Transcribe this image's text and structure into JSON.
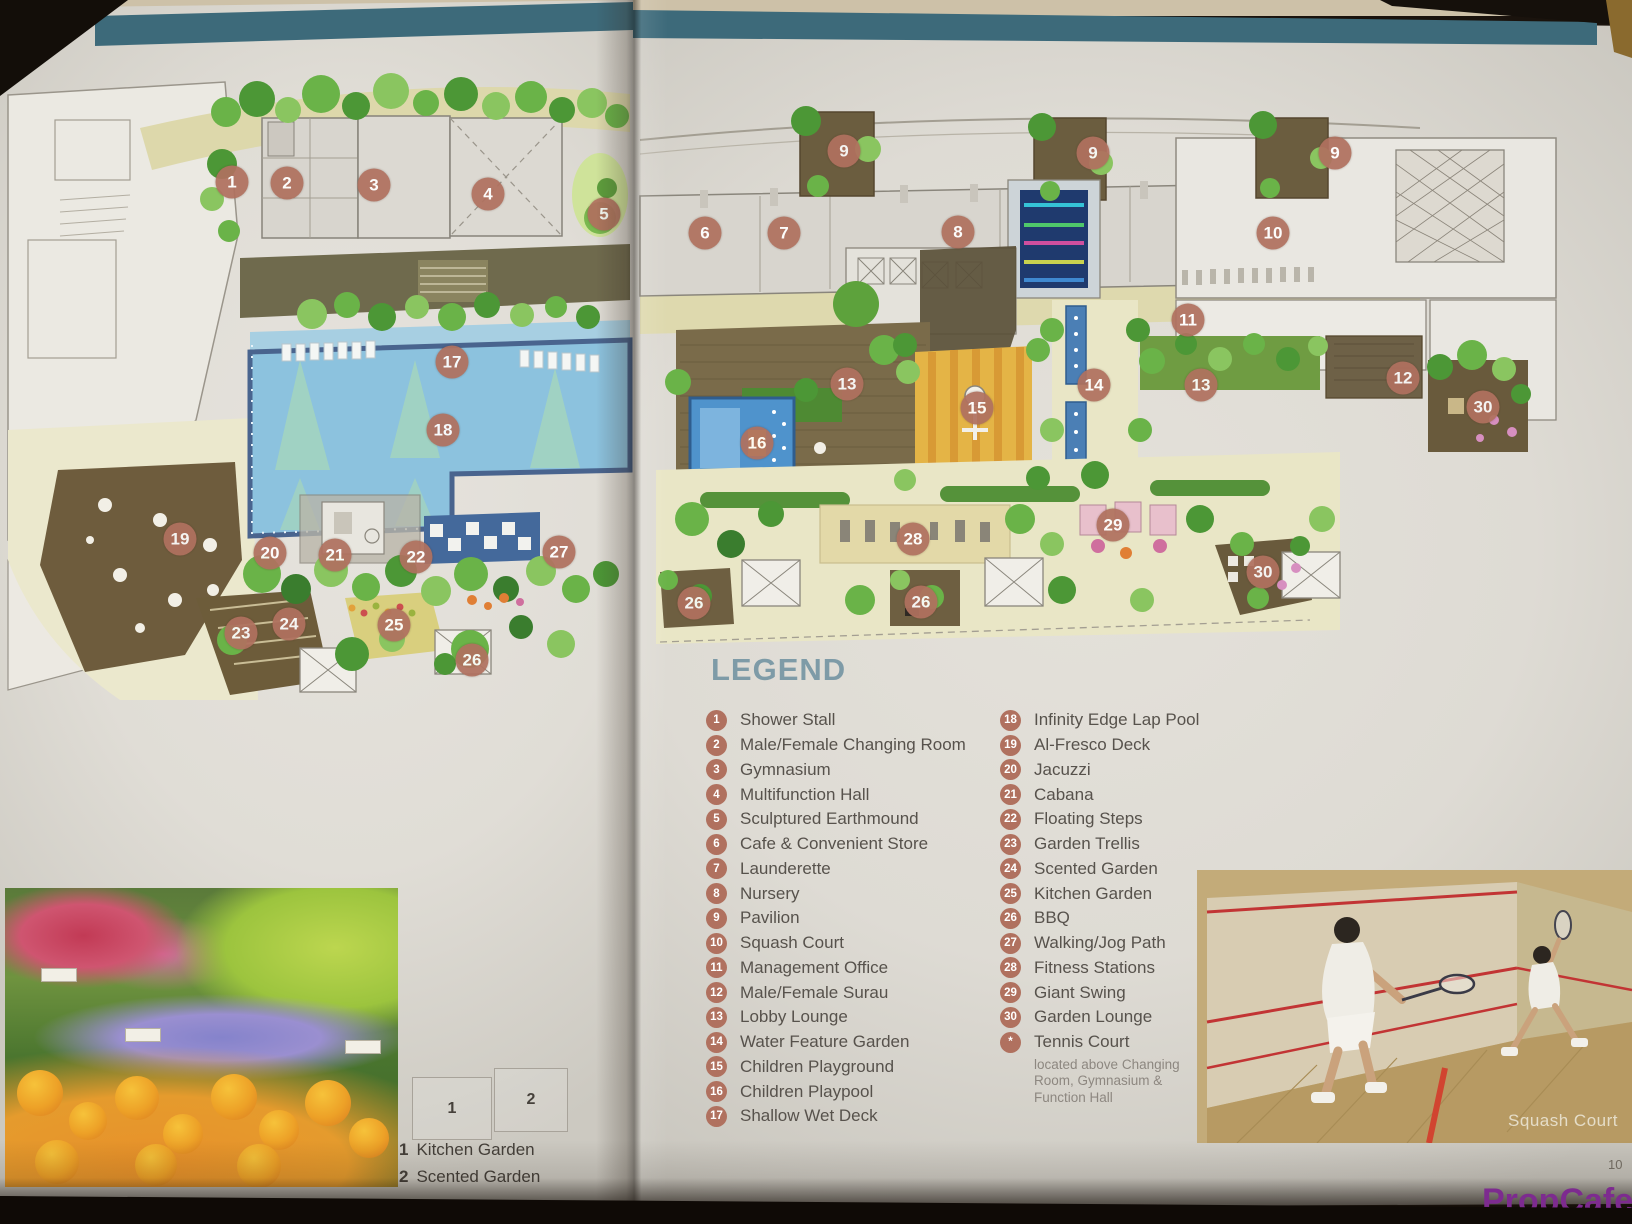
{
  "colors": {
    "marker_badge": "#b0715f",
    "legend_title": "#7e9ba7",
    "legend_text": "#57524c",
    "teal_band": "#3d6a7a",
    "pool_blue": "#8cc2de",
    "watermark_purple": "#7d2b8f"
  },
  "legend": {
    "title": "LEGEND",
    "left": [
      {
        "num": "1",
        "label": "Shower Stall"
      },
      {
        "num": "2",
        "label": "Male/Female Changing Room"
      },
      {
        "num": "3",
        "label": "Gymnasium"
      },
      {
        "num": "4",
        "label": "Multifunction Hall"
      },
      {
        "num": "5",
        "label": "Sculptured Earthmound"
      },
      {
        "num": "6",
        "label": "Cafe & Convenient Store"
      },
      {
        "num": "7",
        "label": "Launderette"
      },
      {
        "num": "8",
        "label": "Nursery"
      },
      {
        "num": "9",
        "label": "Pavilion"
      },
      {
        "num": "10",
        "label": "Squash Court"
      },
      {
        "num": "11",
        "label": "Management Office"
      },
      {
        "num": "12",
        "label": "Male/Female Surau"
      },
      {
        "num": "13",
        "label": "Lobby Lounge"
      },
      {
        "num": "14",
        "label": "Water Feature Garden"
      },
      {
        "num": "15",
        "label": "Children Playground"
      },
      {
        "num": "16",
        "label": "Children Playpool"
      },
      {
        "num": "17",
        "label": "Shallow Wet Deck"
      }
    ],
    "right": [
      {
        "num": "18",
        "label": "Infinity Edge Lap Pool"
      },
      {
        "num": "19",
        "label": "Al-Fresco Deck"
      },
      {
        "num": "20",
        "label": "Jacuzzi"
      },
      {
        "num": "21",
        "label": "Cabana"
      },
      {
        "num": "22",
        "label": "Floating Steps"
      },
      {
        "num": "23",
        "label": "Garden Trellis"
      },
      {
        "num": "24",
        "label": "Scented Garden"
      },
      {
        "num": "25",
        "label": "Kitchen Garden"
      },
      {
        "num": "26",
        "label": "BBQ"
      },
      {
        "num": "27",
        "label": "Walking/Jog Path"
      },
      {
        "num": "28",
        "label": "Fitness Stations"
      },
      {
        "num": "29",
        "label": "Giant Swing"
      },
      {
        "num": "30",
        "label": "Garden Lounge"
      }
    ],
    "special": {
      "symbol": "*",
      "label": "Tennis Court",
      "note_lines": [
        "located above Changing",
        "Room, Gymnasium &",
        "Function Hall"
      ]
    }
  },
  "plan": {
    "markers": [
      {
        "n": "1",
        "x": 232,
        "y": 182
      },
      {
        "n": "2",
        "x": 287,
        "y": 183
      },
      {
        "n": "3",
        "x": 374,
        "y": 185
      },
      {
        "n": "4",
        "x": 488,
        "y": 194
      },
      {
        "n": "5",
        "x": 604,
        "y": 214
      },
      {
        "n": "6",
        "x": 705,
        "y": 233
      },
      {
        "n": "7",
        "x": 784,
        "y": 233
      },
      {
        "n": "8",
        "x": 958,
        "y": 232
      },
      {
        "n": "9",
        "x": 844,
        "y": 151
      },
      {
        "n": "9",
        "x": 1093,
        "y": 153
      },
      {
        "n": "9",
        "x": 1335,
        "y": 153
      },
      {
        "n": "10",
        "x": 1273,
        "y": 233
      },
      {
        "n": "11",
        "x": 1188,
        "y": 320
      },
      {
        "n": "12",
        "x": 1403,
        "y": 378
      },
      {
        "n": "13",
        "x": 847,
        "y": 384
      },
      {
        "n": "13",
        "x": 1201,
        "y": 385
      },
      {
        "n": "14",
        "x": 1094,
        "y": 385
      },
      {
        "n": "15",
        "x": 977,
        "y": 408
      },
      {
        "n": "16",
        "x": 757,
        "y": 443
      },
      {
        "n": "17",
        "x": 452,
        "y": 362
      },
      {
        "n": "18",
        "x": 443,
        "y": 430
      },
      {
        "n": "19",
        "x": 180,
        "y": 539
      },
      {
        "n": "20",
        "x": 270,
        "y": 553
      },
      {
        "n": "21",
        "x": 335,
        "y": 555
      },
      {
        "n": "22",
        "x": 416,
        "y": 557
      },
      {
        "n": "23",
        "x": 241,
        "y": 633
      },
      {
        "n": "24",
        "x": 289,
        "y": 624
      },
      {
        "n": "25",
        "x": 394,
        "y": 625
      },
      {
        "n": "26",
        "x": 472,
        "y": 660
      },
      {
        "n": "26",
        "x": 694,
        "y": 603
      },
      {
        "n": "26",
        "x": 921,
        "y": 602
      },
      {
        "n": "27",
        "x": 559,
        "y": 552
      },
      {
        "n": "28",
        "x": 913,
        "y": 539
      },
      {
        "n": "29",
        "x": 1113,
        "y": 525
      },
      {
        "n": "30",
        "x": 1483,
        "y": 407
      },
      {
        "n": "30",
        "x": 1263,
        "y": 572
      }
    ]
  },
  "inset": {
    "boxes": [
      {
        "label": "1"
      },
      {
        "label": "2"
      }
    ],
    "captions": [
      {
        "num": "1",
        "label": "Kitchen Garden"
      },
      {
        "num": "2",
        "label": "Scented Garden"
      }
    ]
  },
  "squash_photo": {
    "caption": "Squash Court"
  },
  "footer": {
    "page_number": "10",
    "watermark": "PropCafe.Net"
  }
}
